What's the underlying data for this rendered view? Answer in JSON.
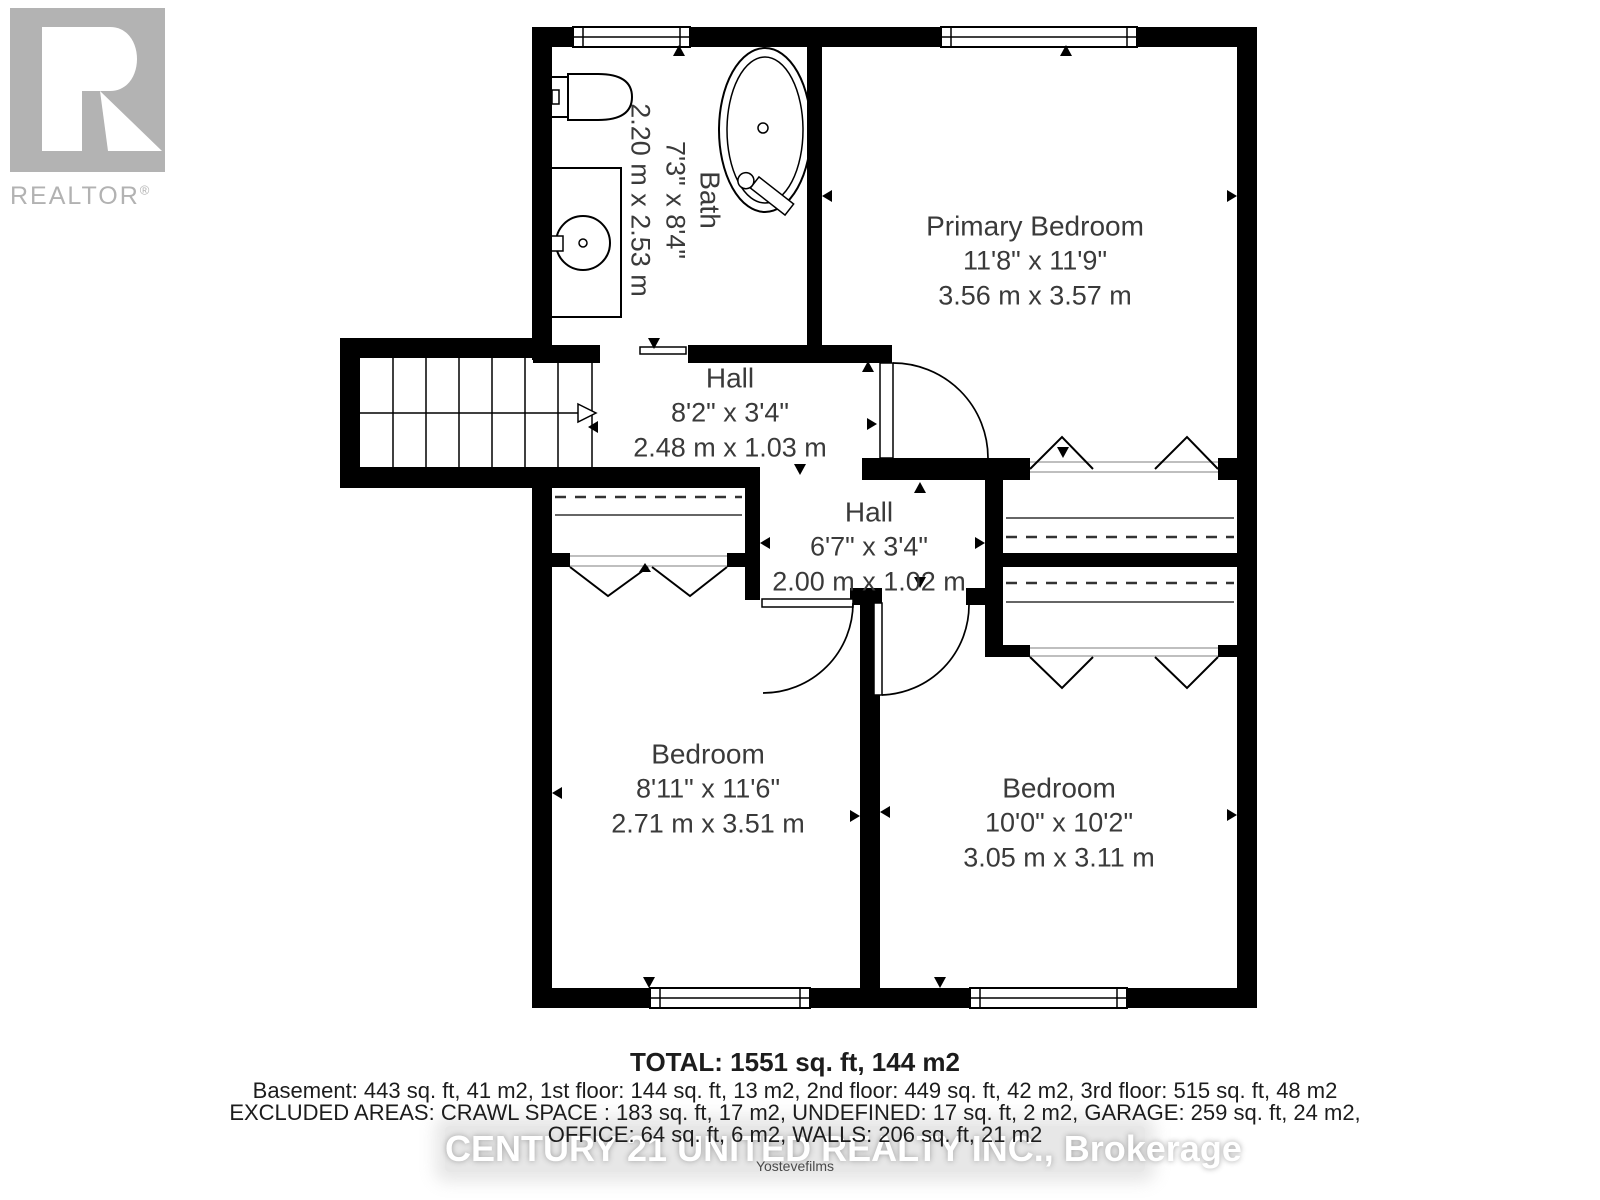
{
  "branding": {
    "realtor_label": "REALTOR",
    "registered_mark": "®"
  },
  "rooms": {
    "bath": {
      "name": "Bath",
      "imperial": "7'3\" x 8'4\"",
      "metric": "2.20 m x 2.53 m"
    },
    "primary_bedroom": {
      "name": "Primary Bedroom",
      "imperial": "11'8\" x 11'9\"",
      "metric": "3.56 m x 3.57 m"
    },
    "hall_upper": {
      "name": "Hall",
      "imperial": "8'2\" x 3'4\"",
      "metric": "2.48 m x 1.03 m"
    },
    "hall_lower": {
      "name": "Hall",
      "imperial": "6'7\" x 3'4\"",
      "metric": "2.00 m x 1.02 m"
    },
    "bedroom_left": {
      "name": "Bedroom",
      "imperial": "8'11\" x 11'6\"",
      "metric": "2.71 m x 3.51 m"
    },
    "bedroom_right": {
      "name": "Bedroom",
      "imperial": "10'0\" x 10'2\"",
      "metric": "3.05 m x 3.11 m"
    }
  },
  "summary": {
    "total": "TOTAL: 1551 sq. ft, 144 m2",
    "floors": "Basement: 443 sq. ft, 41 m2, 1st floor: 144 sq. ft, 13 m2, 2nd floor: 449 sq. ft, 42 m2, 3rd floor: 515 sq. ft, 48 m2",
    "excluded_line1": "EXCLUDED AREAS: CRAWL SPACE : 183 sq. ft, 17 m2, UNDEFINED: 17 sq. ft, 2 m2, GARAGE: 259 sq. ft, 24 m2,",
    "excluded_line2": "OFFICE: 64 sq. ft, 6 m2, WALLS: 206 sq. ft, 21 m2"
  },
  "watermark": {
    "brokerage": "CENTURY 21 UNITED REALTY INC., Brokerage",
    "credit": "Yostevefilms"
  },
  "colors": {
    "wall": "#000000",
    "label_text": "#3a3a3a",
    "logo_gray": "#b2b2b2",
    "watermark_text": "#ffffff",
    "watermark_band": "#dadada"
  }
}
